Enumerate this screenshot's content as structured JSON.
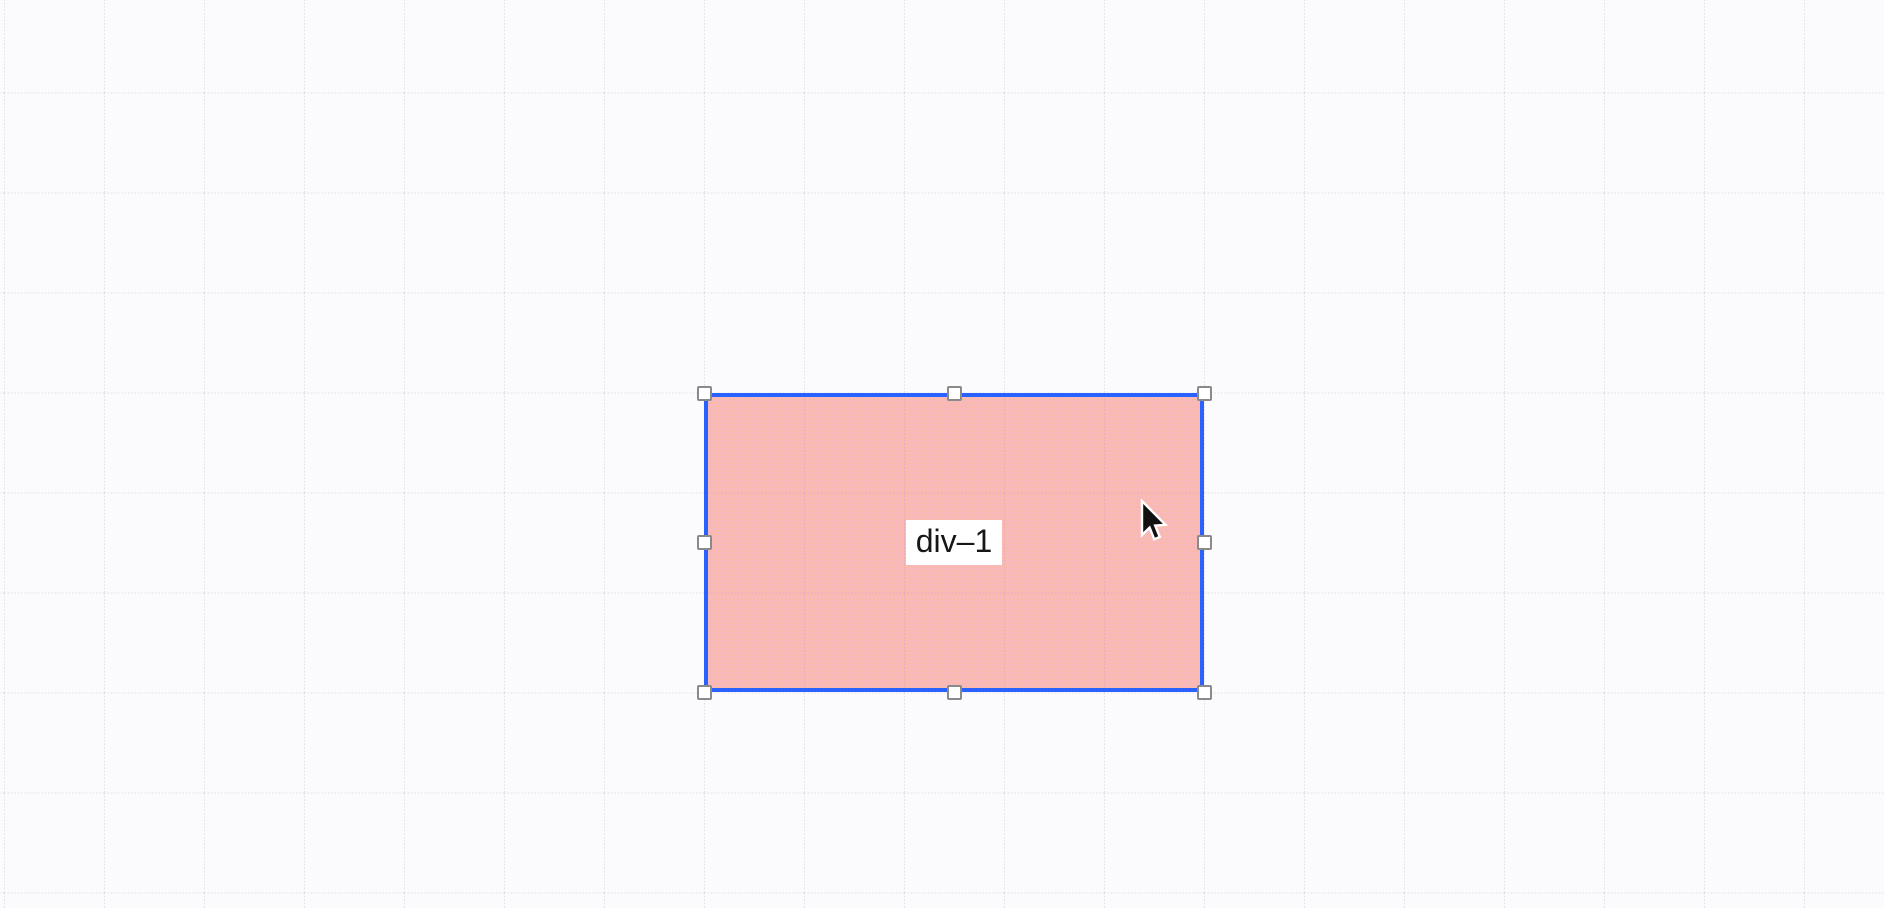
{
  "canvas": {
    "background_color": "#fbfbfd",
    "grid": {
      "spacing_px": 100,
      "style": "dotted",
      "line_color": "#e0e0e8"
    },
    "selected_element": {
      "label": "div–1",
      "fill_color": "rgba(242, 92, 98, 0.42)",
      "texture_dot_color": "rgba(255, 186, 120, 0.45)",
      "selection_border_color": "#2962ff",
      "label_background": "#ffffff",
      "label_text_color": "#171717",
      "handles": {
        "fill": "#ffffff",
        "border": "#8a8a8a",
        "positions": [
          "top-left",
          "top",
          "top-right",
          "left",
          "right",
          "bottom-left",
          "bottom",
          "bottom-right"
        ]
      }
    },
    "cursor": "arrow-pointer"
  }
}
